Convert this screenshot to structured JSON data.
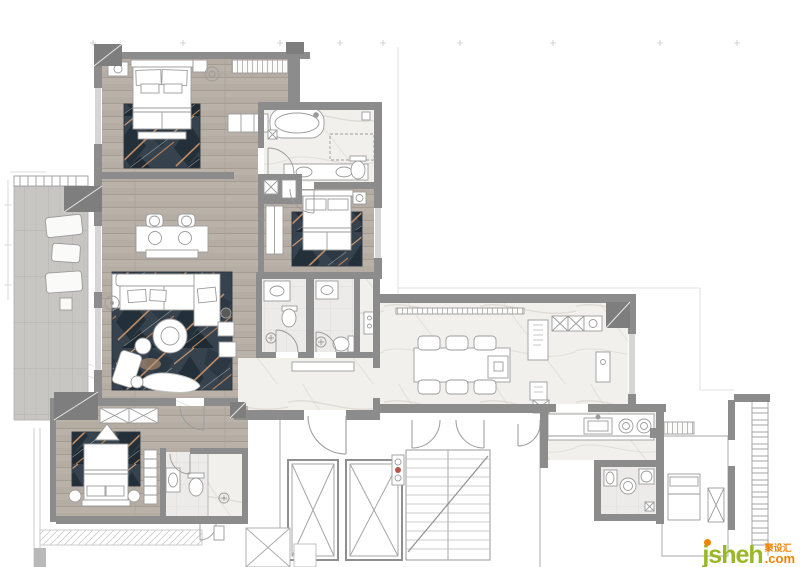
{
  "watermark": {
    "brand": "jsheh",
    "domain_suffix": ".com",
    "cn_label": "聚设汇"
  },
  "palette": {
    "wall": "#8c8c8c",
    "column": "#7e7e7e",
    "wood_floor": "#b5ada3",
    "marble_floor": "#f2f0ed",
    "tile_floor": "#ecebe9",
    "balcony_floor": "#c8c6c3",
    "rug_base": "#36434f",
    "rug_accent": "#bd8a63",
    "furniture_outline": "#9b9b9b",
    "watermark_green": "#9ab825",
    "watermark_orange": "#f08300"
  }
}
